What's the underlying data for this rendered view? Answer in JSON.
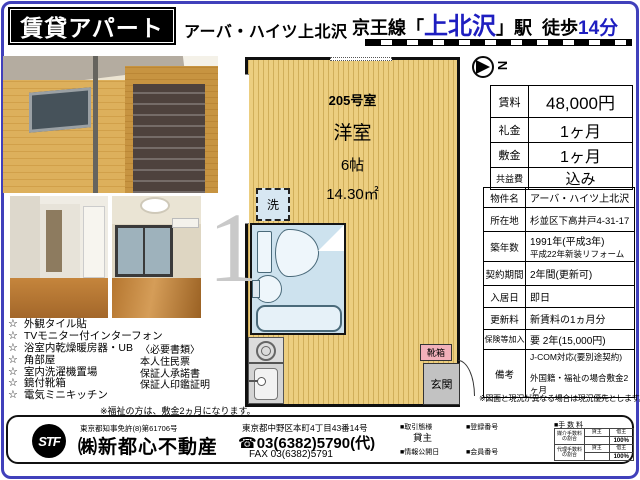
{
  "colors": {
    "accent_blue": "#1e1ec0",
    "frame_blue": "#4040bb",
    "plan_fill": "#ecce80",
    "bath_fill": "#cde2ee",
    "shoebox_pink": "#f2b0ba"
  },
  "header": {
    "banner": "賃貸アパート",
    "title": "アーバ・ハイツ上北沢",
    "line": "京王線",
    "bracket_open": "「",
    "station": "上北沢",
    "bracket_close": "」駅",
    "walk": "  徒歩",
    "walk_minutes": "14分"
  },
  "compass": {
    "north": "N"
  },
  "watermark": "1",
  "floorplan": {
    "room_number": "205号室",
    "room_type": "洋室",
    "size_tatami": "6帖",
    "area": "14.30㎡",
    "washer": "洗",
    "shoe_box": "靴箱",
    "entrance": "玄関"
  },
  "price_table": {
    "rows": [
      {
        "label": "賃料",
        "value": "48,000円"
      },
      {
        "label": "礼金",
        "value": "1ヶ月"
      },
      {
        "label": "敷金",
        "value": "1ヶ月"
      },
      {
        "label": "共益費",
        "value": "込み"
      }
    ]
  },
  "detail_table": {
    "rows": [
      {
        "label": "物件名",
        "value": "アーバ・ハイツ上北沢"
      },
      {
        "label": "所在地",
        "value": "杉並区下高井戸4-31-17"
      },
      {
        "label": "築年数",
        "value": "1991年(平成3年)",
        "value2": "平成22年新装リフォーム"
      },
      {
        "label": "契約期間",
        "value": "2年間(更新可)"
      },
      {
        "label": "入居日",
        "value": "即日"
      },
      {
        "label": "更新料",
        "value": "新賃料の1ヵ月分"
      },
      {
        "label": "保険等加入",
        "value": "要 2年(15,000円)"
      },
      {
        "label": "備考",
        "value": "J-COM対応(要別途契約)",
        "value2": "外国籍・福祉の場合敷金2ヶ月"
      }
    ],
    "note": "※図面と現況が異なる場合は現況優先とします。"
  },
  "features": {
    "star": "☆",
    "items": [
      "外観タイル貼",
      "TVモニター付インターフォン",
      "浴室内乾燥暖房器・UB",
      "角部屋",
      "室内洗濯機置場",
      "鏡付靴箱",
      "電気ミニキッチン"
    ]
  },
  "documents": {
    "title": "〈必要書類〉",
    "items": [
      "本人住民票",
      "保証人承諾書",
      "保証人印鑑証明"
    ]
  },
  "welfare_note": "※福祉の方は、敷金2ヵ月になります。",
  "company": {
    "logo": "STF",
    "license": "東京都知事免許(8)第61706号",
    "name": "㈱新都心不動産",
    "address": "東京都中野区本町4丁目43番14号",
    "phone_icon": "☎",
    "phone": "03(6382)5790(代)",
    "fax": "FAX 03(6382)5791",
    "meta": {
      "deal_type_label": "■取引態様",
      "deal_type_value": "貸主",
      "publish_label": "■情報公開日",
      "registration_label": "■登録番号",
      "member_label": "■会員番号",
      "fee_label": "■手 数 料",
      "fee_table": {
        "row1_label": "媒介手数料の割合",
        "row2_label": "代理手数料の割合",
        "col1": "貸主",
        "col2": "借主",
        "row1_value": "100%",
        "row2_value": "100%"
      }
    }
  }
}
